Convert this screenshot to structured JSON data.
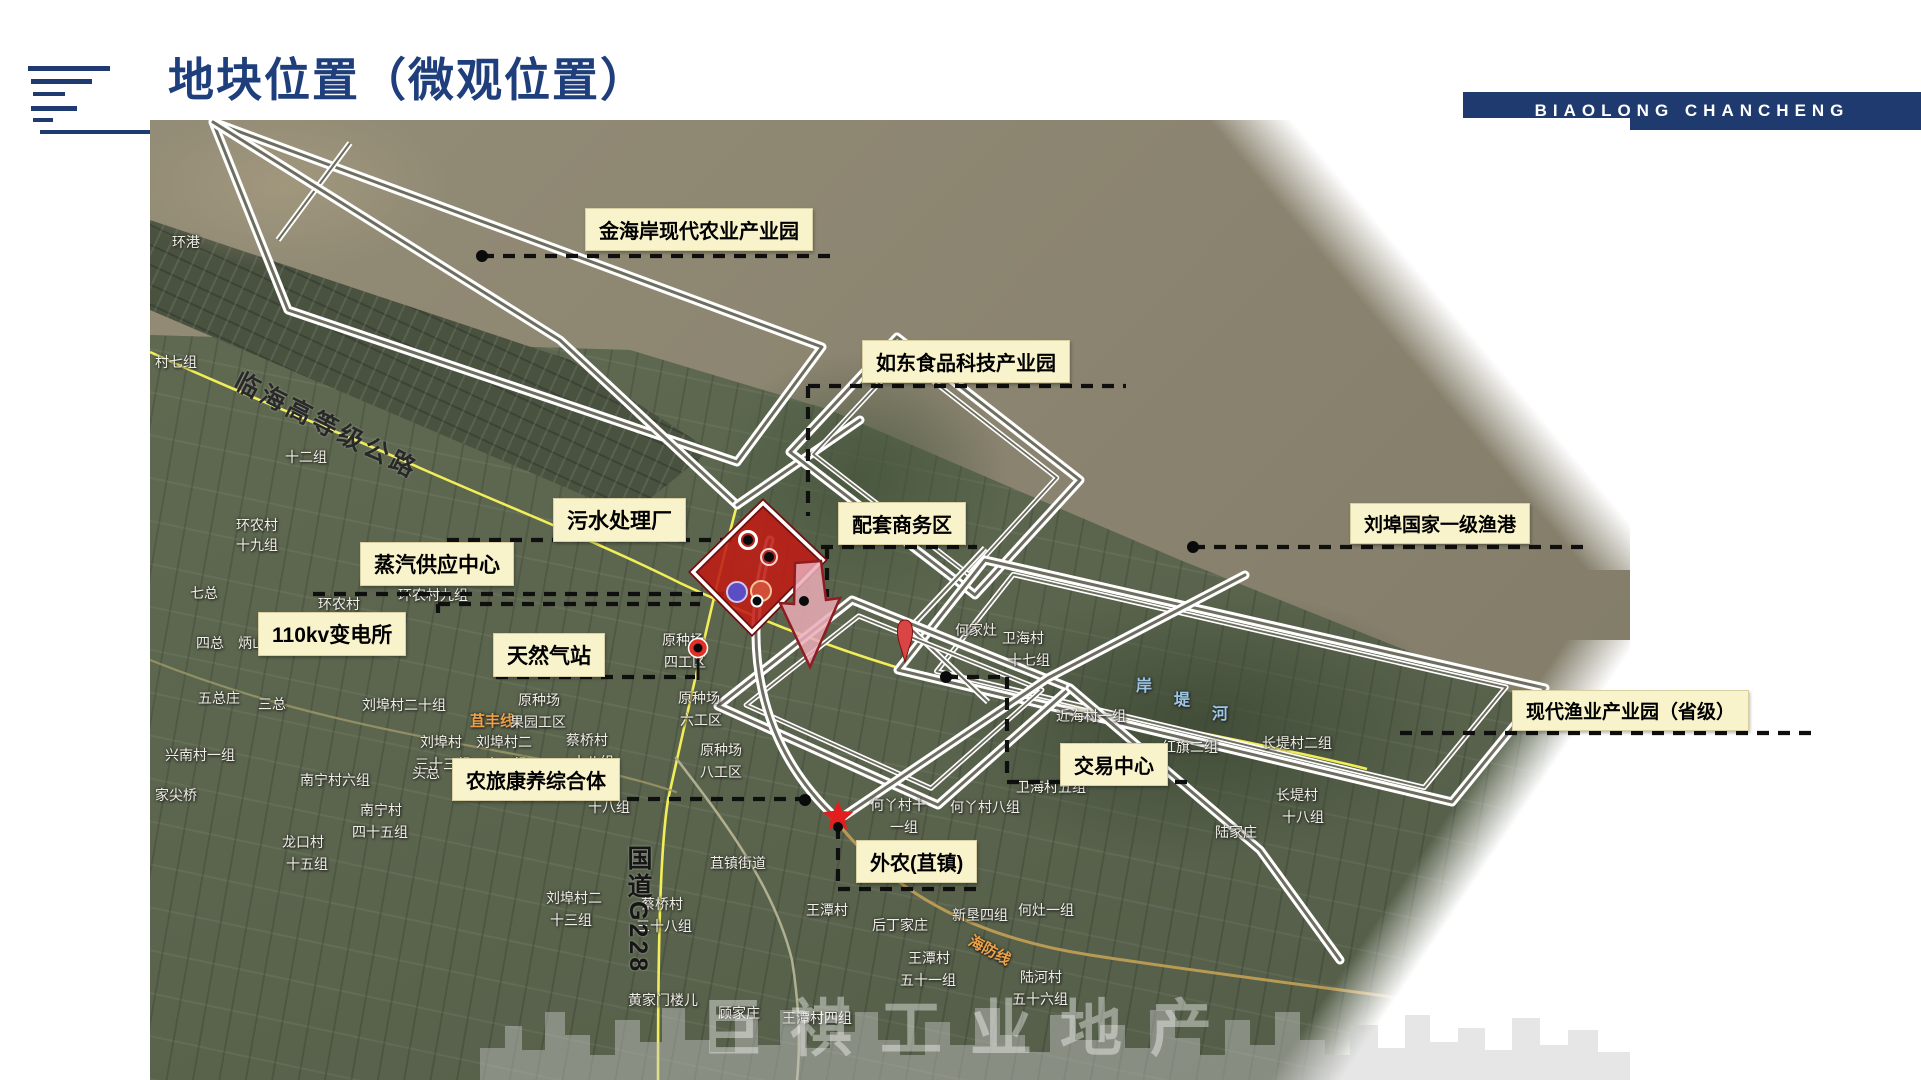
{
  "header": {
    "title": "地块位置（微观位置）",
    "logo_text": "BIAOLONG CHANCHENG",
    "accent_color": "#1e3a6e"
  },
  "map": {
    "watermark": "巨祺工业地产",
    "colors": {
      "callout_bg": "#f9f3cb",
      "parcel_red": "#bf1b15",
      "pink_parcel": "#eaacb6",
      "road_yellow": "#f2ee58",
      "dash_black": "#0f0f0f",
      "orange_road_label": "#ecA145"
    },
    "callouts": [
      {
        "id": "jinhaian",
        "text": "金海岸现代农业产业园",
        "x": 585,
        "y": 208,
        "fs": 20
      },
      {
        "id": "rudong",
        "text": "如东食品科技产业园",
        "x": 862,
        "y": 340,
        "fs": 20
      },
      {
        "id": "wushui",
        "text": "污水处理厂",
        "x": 553,
        "y": 498,
        "fs": 21
      },
      {
        "id": "peitao",
        "text": "配套商务区",
        "x": 838,
        "y": 502,
        "fs": 20
      },
      {
        "id": "zhengqi",
        "text": "蒸汽供应中心",
        "x": 360,
        "y": 542,
        "fs": 21
      },
      {
        "id": "biandiansuo",
        "text": "110kv变电所",
        "x": 258,
        "y": 612,
        "fs": 21
      },
      {
        "id": "tianranqi",
        "text": "天然气站",
        "x": 493,
        "y": 633,
        "fs": 21
      },
      {
        "id": "liubu",
        "text": "刘埠国家一级渔港",
        "x": 1350,
        "y": 503,
        "fs": 19
      },
      {
        "id": "xiandaiyuye",
        "text": "现代渔业产业园（省级）",
        "x": 1512,
        "y": 690,
        "fs": 19
      },
      {
        "id": "jiaoyi",
        "text": "交易中心",
        "x": 1060,
        "y": 743,
        "fs": 20
      },
      {
        "id": "nonglv",
        "text": "农旅康养综合体",
        "x": 452,
        "y": 758,
        "fs": 20
      },
      {
        "id": "wainong",
        "text": "外农(苴镇)",
        "x": 856,
        "y": 840,
        "fs": 20
      }
    ],
    "place_labels": [
      {
        "t": "环港",
        "x": 172,
        "y": 232
      },
      {
        "t": "村七组",
        "x": 155,
        "y": 352
      },
      {
        "t": "十二组",
        "x": 285,
        "y": 447
      },
      {
        "t": "环农村",
        "x": 236,
        "y": 515
      },
      {
        "t": "十九组",
        "x": 236,
        "y": 535
      },
      {
        "t": "七总",
        "x": 190,
        "y": 583
      },
      {
        "t": "环农村",
        "x": 318,
        "y": 594
      },
      {
        "t": "环农村九组",
        "x": 398,
        "y": 585
      },
      {
        "t": "四总",
        "x": 196,
        "y": 633
      },
      {
        "t": "炳山八组",
        "x": 238,
        "y": 633
      },
      {
        "t": "五总庄",
        "x": 198,
        "y": 688
      },
      {
        "t": "三总",
        "x": 258,
        "y": 694
      },
      {
        "t": "刘埠村二十组",
        "x": 362,
        "y": 695
      },
      {
        "t": "苴丰线",
        "x": 470,
        "y": 710,
        "c": "orange"
      },
      {
        "t": "兴南村一组",
        "x": 165,
        "y": 745
      },
      {
        "t": "刘埠村　刘埠村二",
        "x": 420,
        "y": 732
      },
      {
        "t": "三十三组　十三组",
        "x": 415,
        "y": 754
      },
      {
        "t": "家尖桥",
        "x": 155,
        "y": 785
      },
      {
        "t": "南宁村六组",
        "x": 300,
        "y": 770
      },
      {
        "t": "蔡桥村",
        "x": 566,
        "y": 730
      },
      {
        "t": "十八组",
        "x": 572,
        "y": 752
      },
      {
        "t": "南宁村",
        "x": 360,
        "y": 800
      },
      {
        "t": "四十五组",
        "x": 352,
        "y": 822
      },
      {
        "t": "龙口村",
        "x": 282,
        "y": 832
      },
      {
        "t": "十五组",
        "x": 286,
        "y": 854
      },
      {
        "t": "原种场",
        "x": 518,
        "y": 690
      },
      {
        "t": "果园工区",
        "x": 510,
        "y": 712
      },
      {
        "t": "原种场",
        "x": 662,
        "y": 630
      },
      {
        "t": "四工区",
        "x": 664,
        "y": 652
      },
      {
        "t": "原种场",
        "x": 678,
        "y": 688
      },
      {
        "t": "六工区",
        "x": 680,
        "y": 710
      },
      {
        "t": "原种场",
        "x": 700,
        "y": 740
      },
      {
        "t": "八工区",
        "x": 700,
        "y": 762
      },
      {
        "t": "头总",
        "x": 412,
        "y": 763
      },
      {
        "t": "十八组",
        "x": 588,
        "y": 797
      },
      {
        "t": "苴镇街道",
        "x": 710,
        "y": 853
      },
      {
        "t": "刘埠村二",
        "x": 546,
        "y": 888
      },
      {
        "t": "十三组",
        "x": 550,
        "y": 910
      },
      {
        "t": "蔡桥村",
        "x": 641,
        "y": 894
      },
      {
        "t": "三十八组",
        "x": 636,
        "y": 916
      },
      {
        "t": "黄家门楼儿",
        "x": 628,
        "y": 990
      },
      {
        "t": "顾家庄",
        "x": 718,
        "y": 1003
      },
      {
        "t": "王潭村四组",
        "x": 782,
        "y": 1008
      },
      {
        "t": "王潭村",
        "x": 806,
        "y": 900
      },
      {
        "t": "后丁家庄",
        "x": 872,
        "y": 915
      },
      {
        "t": "新垦四组",
        "x": 952,
        "y": 905
      },
      {
        "t": "何灶一组",
        "x": 1018,
        "y": 900
      },
      {
        "t": "王潭村",
        "x": 908,
        "y": 948
      },
      {
        "t": "五十一组",
        "x": 900,
        "y": 970
      },
      {
        "t": "陆河村",
        "x": 1020,
        "y": 967
      },
      {
        "t": "五十六组",
        "x": 1012,
        "y": 989
      },
      {
        "t": "海防线",
        "x": 975,
        "y": 930,
        "c": "orange",
        "r": 28
      },
      {
        "t": "何丫村十",
        "x": 870,
        "y": 795
      },
      {
        "t": "一组",
        "x": 890,
        "y": 817
      },
      {
        "t": "何丫村八组",
        "x": 950,
        "y": 797
      },
      {
        "t": "何家灶",
        "x": 955,
        "y": 620
      },
      {
        "t": "卫海村",
        "x": 1002,
        "y": 628
      },
      {
        "t": "十七组",
        "x": 1008,
        "y": 650
      },
      {
        "t": "近海村一组",
        "x": 1056,
        "y": 706
      },
      {
        "t": "卫海村九组",
        "x": 1062,
        "y": 740
      },
      {
        "t": "红旗二组",
        "x": 1162,
        "y": 737
      },
      {
        "t": "长堤村二组",
        "x": 1262,
        "y": 733
      },
      {
        "t": "卫海村五组",
        "x": 1016,
        "y": 777
      },
      {
        "t": "长堤村",
        "x": 1276,
        "y": 785
      },
      {
        "t": "十八组",
        "x": 1282,
        "y": 807
      },
      {
        "t": "陆家庄",
        "x": 1215,
        "y": 822
      },
      {
        "t": "岸",
        "x": 1136,
        "y": 672,
        "c": "blue"
      },
      {
        "t": "堤",
        "x": 1174,
        "y": 686,
        "c": "blue"
      },
      {
        "t": "河",
        "x": 1212,
        "y": 700,
        "c": "blue"
      },
      {
        "t": "国道G228",
        "x": 620,
        "y": 845,
        "c": "g228"
      },
      {
        "t": "临海高等级公路",
        "x": 245,
        "y": 362,
        "c": "bigroad",
        "r": 27
      }
    ]
  }
}
